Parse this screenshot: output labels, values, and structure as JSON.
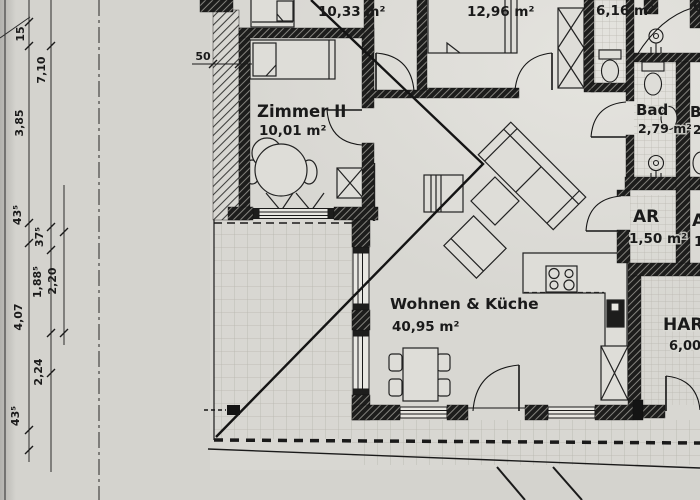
{
  "document": {
    "kind": "architectural floor plan photo",
    "language": "de"
  },
  "colors": {
    "paper": "#d6d5d0",
    "ink": "#1a1a1a",
    "wall_fill": "#1b1b1a",
    "tile_line": "#b7b5ad"
  },
  "rooms": {
    "top_left": {
      "area": "10,33 m²"
    },
    "zimmer2": {
      "name": "Zimmer II",
      "area": "10,01 m²"
    },
    "schlafzimmer": {
      "area": "12,96 m²"
    },
    "wc": {
      "area": "6,16 m²"
    },
    "bad": {
      "name": "Bad",
      "area": "2,79 m²"
    },
    "ar": {
      "name": "AR",
      "area": "1,50 m²"
    },
    "har": {
      "name": "HAR",
      "area": "6,00 m²"
    },
    "wohnen": {
      "name": "Wohnen & Küche",
      "area": "40,95 m²"
    }
  },
  "dims": {
    "wall": "50",
    "inner": {
      "v15": "15",
      "v385": "3,85",
      "v435a": "43⁵",
      "v407": "4,07",
      "v435b": "43⁵"
    },
    "outer": {
      "v710": "7,10",
      "v375": "37⁵",
      "v1885": "1,88⁵",
      "v224": "2,24"
    },
    "third": {
      "v220": "2,20"
    }
  },
  "partials": {
    "p6": "6",
    "pB": "B",
    "p2": "2,",
    "pA": "A",
    "p1": "1,"
  }
}
